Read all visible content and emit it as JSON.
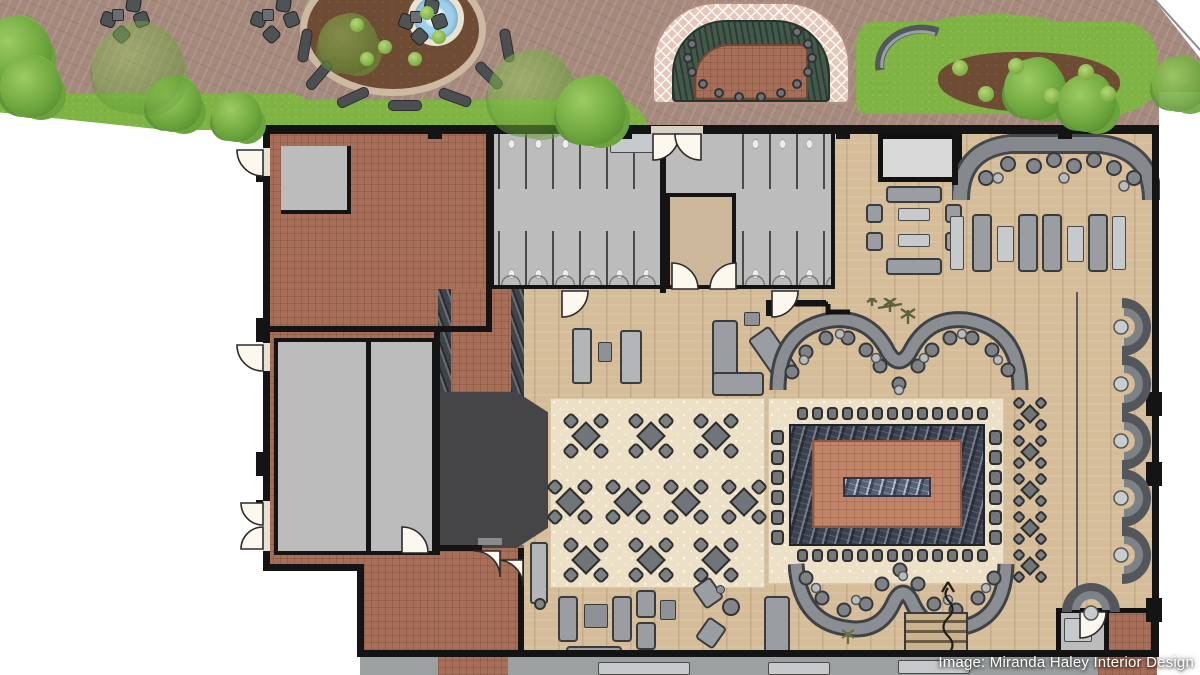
{
  "caption": {
    "text": "Image: Miranda Haley Interior Design"
  },
  "palette": {
    "wall": "#141414",
    "paving": "#a5897d",
    "grass": "#7fb445",
    "foliage": "#6fa83e",
    "soil": "#6e4c34",
    "fountain_water": "#9fd0ea",
    "wood_floor": "#d5bd99",
    "terracotta_tile": "#a86f58",
    "island_terracotta": "#c08568",
    "room_gray": "#bcbcbc",
    "furniture_gray": "#8e9296",
    "furniture_dark": "#4b4f52",
    "bar_counter": "#454548",
    "marble": "#3a404d",
    "carpet_cream": "#ece0c6",
    "lattice_pink": "#e6c8ba",
    "pond_green": "#44594c",
    "caption_text": "#ffffff"
  },
  "inventory": {
    "dining_table_clusters": 10,
    "chairs_per_dining_table": 4,
    "island_stools": {
      "top": 13,
      "bottom": 13,
      "left": 6,
      "right": 6
    },
    "two_top_tables": 5,
    "wall_booths": 5,
    "corner_booths": 1,
    "north_banquette_seats": 13,
    "south_banquette_seats": 11,
    "fountains": 1,
    "fountain_benches": 7,
    "patio_seating_clusters": 3,
    "water_feature_stools": 13,
    "restroom_blocks": 2,
    "fireplaces": 1
  }
}
